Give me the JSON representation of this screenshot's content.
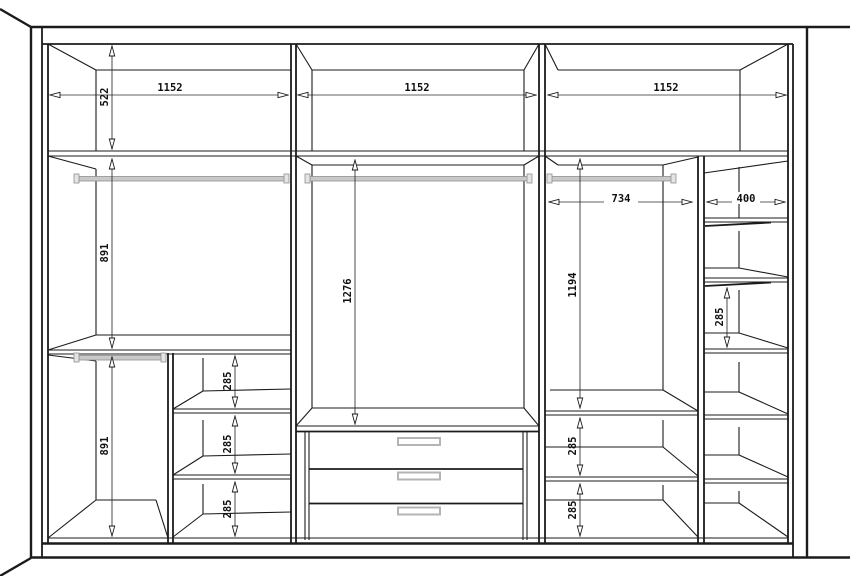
{
  "drawing": {
    "kind": "wardrobe-interior-elevation",
    "dims": {
      "height_522": "522",
      "width_1152_left": "1152",
      "width_1152_middle": "1152",
      "width_1152_right": "1152",
      "height_891_upper": "891",
      "height_891_lower": "891",
      "height_1276": "1276",
      "height_1194": "1194",
      "width_734": "734",
      "width_400": "400",
      "gap_285_left_1": "285",
      "gap_285_left_2": "285",
      "gap_285_left_3": "285",
      "gap_285_right_1": "285",
      "gap_285_right_2": "285",
      "gap_285_column": "285"
    },
    "components": {
      "hanging_rods": 4,
      "drawers": 3,
      "sections": 3
    }
  },
  "colors": {
    "line": "#1b1b1b",
    "dim_line": "#2b2b2b",
    "text": "#111111",
    "rod": "#c9c9c9",
    "rod_edge": "#8f8f8f",
    "handle_fill": "#ffffff",
    "handle_edge": "#b4b4b4",
    "background": "#ffffff"
  }
}
